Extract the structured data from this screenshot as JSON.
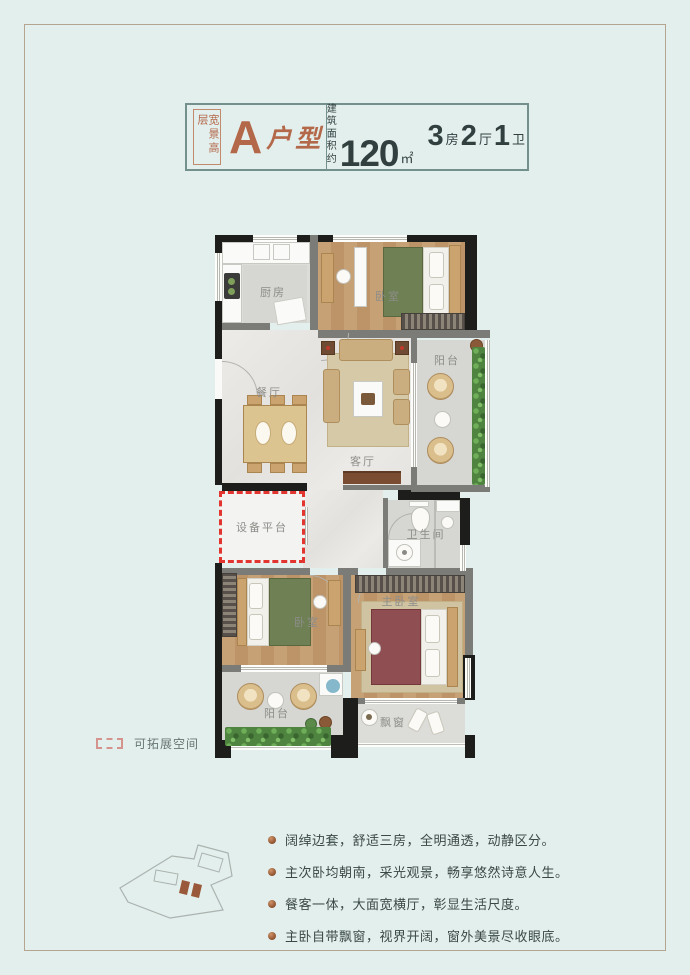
{
  "header": {
    "series_vertical": "宽景高层",
    "unit_letter": "A",
    "unit_type": "户型",
    "area_label_line1": "建筑",
    "area_label_line2": "面积约",
    "area_value": "120",
    "area_unit": "㎡",
    "layout": [
      {
        "count": "3",
        "unit": "房"
      },
      {
        "count": "2",
        "unit": "厅"
      },
      {
        "count": "1",
        "unit": "卫"
      }
    ]
  },
  "plan": {
    "rooms": {
      "kitchen": "厨房",
      "bedroom_top": "卧室",
      "balcony_right": "阳台",
      "dining": "餐厅",
      "living": "客厅",
      "equipment_platform": "设备平台",
      "bathroom": "卫生间",
      "bedroom_second": "卧室",
      "master_bedroom": "主卧室",
      "balcony_bottom": "阳台",
      "bay_window": "飘窗"
    }
  },
  "legend": {
    "expandable_label": "可拓展空间"
  },
  "features": [
    "阔绰边套，舒适三房，全明通透，动静区分。",
    "主次卧均朝南，采光观景，畅享悠然诗意人生。",
    "餐客一体，大面宽横厅，彰显生活尺度。",
    "主卧自带飘窗，视界开阔，窗外美景尽收眼底。"
  ],
  "colors": {
    "accent_copper": "#b4684a",
    "text_dark": "#31403f",
    "expand_red": "#e23530",
    "background": "#e3efed"
  }
}
